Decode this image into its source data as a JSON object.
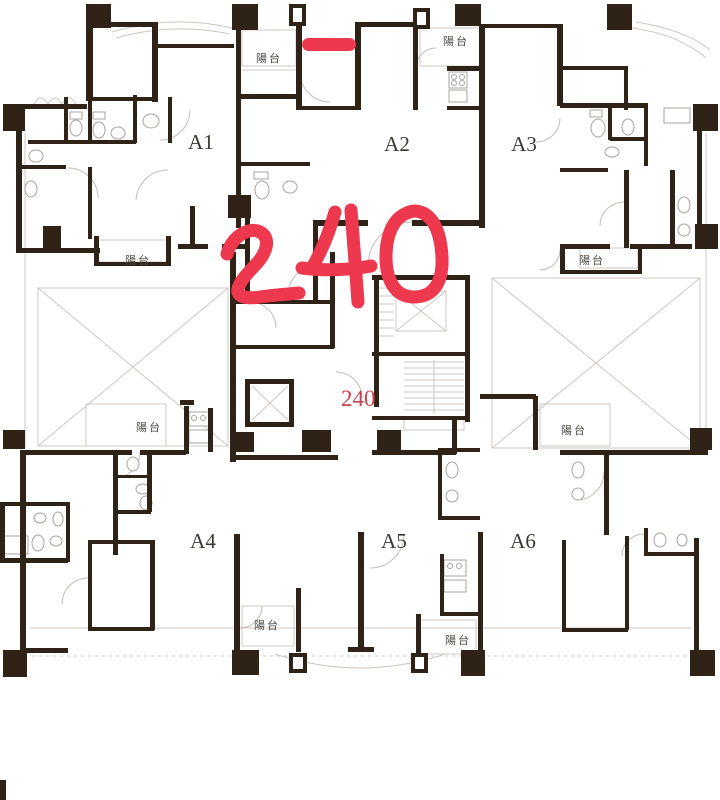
{
  "image_type": "architectural floor plan (residential tower typical floor)",
  "units": [
    {
      "id": "A1",
      "label": "A1"
    },
    {
      "id": "A2",
      "label": "A2"
    },
    {
      "id": "A3",
      "label": "A3"
    },
    {
      "id": "A4",
      "label": "A4"
    },
    {
      "id": "A5",
      "label": "A5"
    },
    {
      "id": "A6",
      "label": "A6"
    }
  ],
  "balcony_labels": [
    {
      "position": "a2-top-left",
      "label": "陽台"
    },
    {
      "position": "a2-top-right",
      "label": "陽台"
    },
    {
      "position": "a1-bottom",
      "label": "陽台"
    },
    {
      "position": "a3-bottom",
      "label": "陽台"
    },
    {
      "position": "a4-upper",
      "label": "陽台"
    },
    {
      "position": "a6-upper",
      "label": "陽台"
    },
    {
      "position": "a4-bottom",
      "label": "陽台"
    },
    {
      "position": "a5-bottom",
      "label": "陽台"
    }
  ],
  "annotations": {
    "printed_value": "240",
    "handwritten_value": "240",
    "dash_mark": "red-marker-dash"
  },
  "colors": {
    "background": "#ffffff",
    "wall": "#2e2316",
    "line_light": "#ccc7c0",
    "door_arc": "#c3beb7",
    "fixture": "#a9a49d",
    "label_dark": "#3a3833",
    "balcony_text": "#4c4944",
    "marker_red": "#ee384e",
    "printed_red": "#c8434f"
  }
}
